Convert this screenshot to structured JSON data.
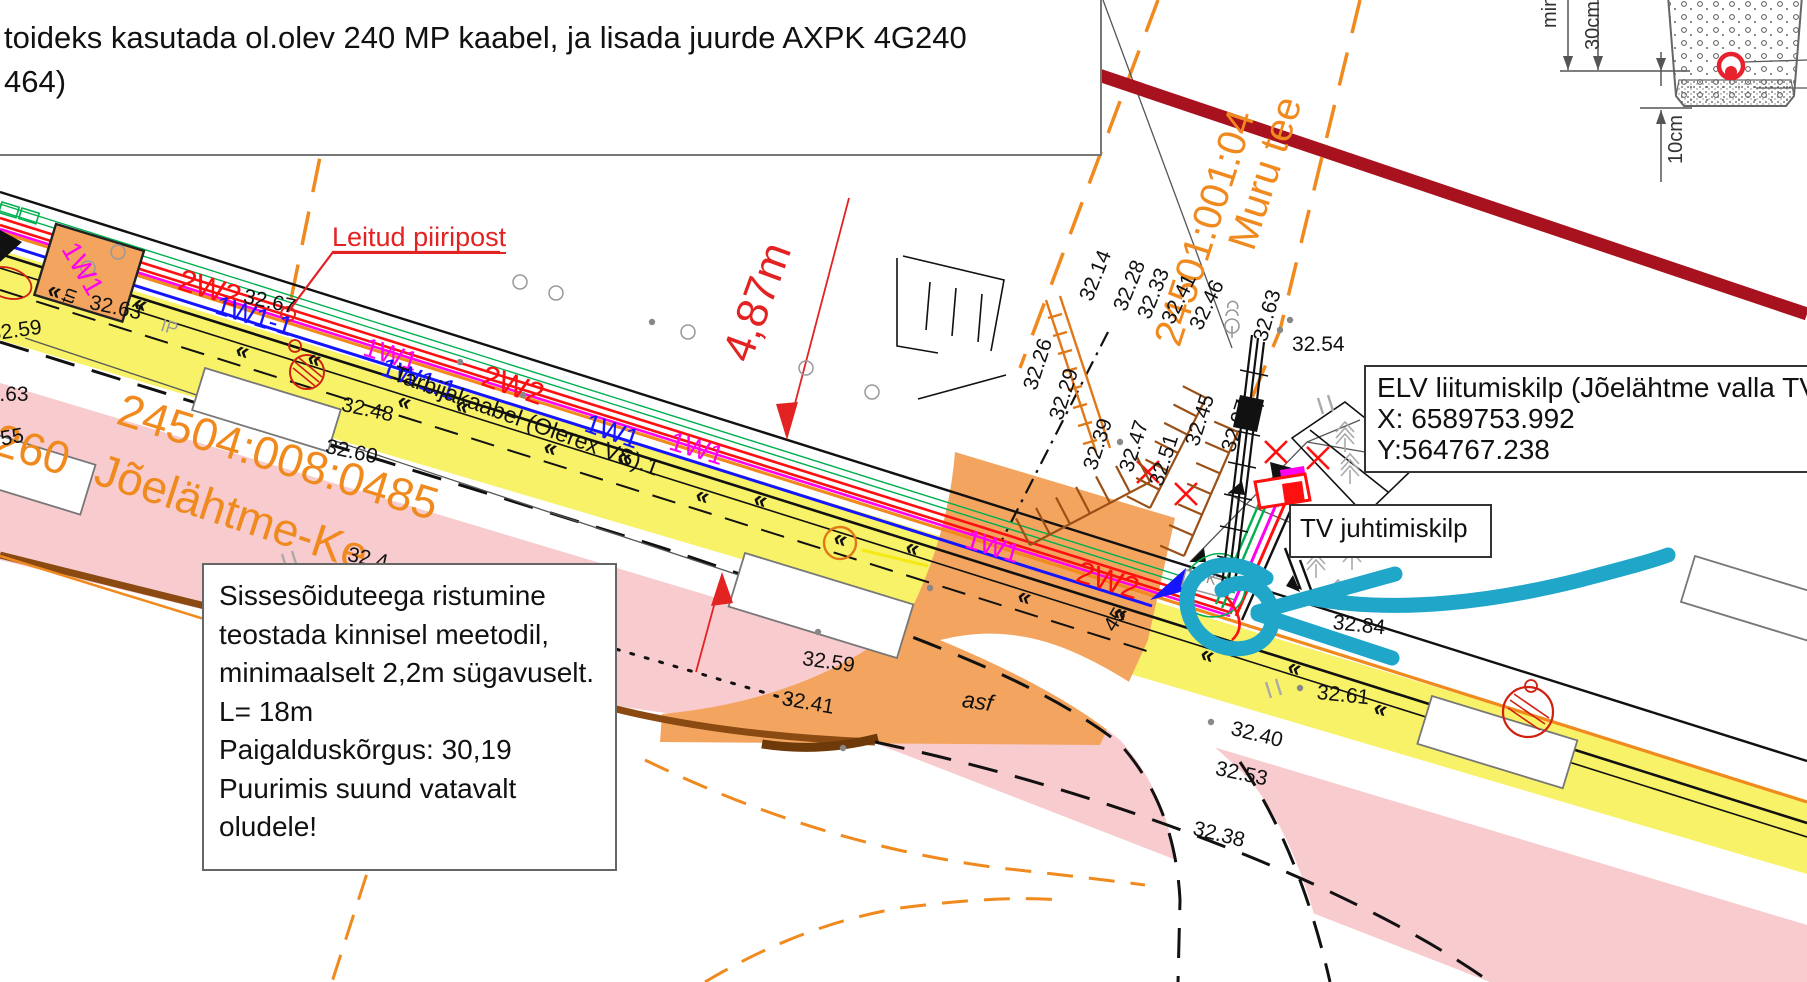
{
  "colors": {
    "road_pink": "#f8cbce",
    "verge_yellow": "#f8f268",
    "driveway_tan": "#f3a55f",
    "boundary_orange": "#f08a1e",
    "existing_cable_red": "#ff1010",
    "project_cable_blue": "#1515ff",
    "project_cable_magenta": "#ff00f0",
    "comm_green": "#00b050",
    "road_edge_brown": "#8a4a12",
    "import_line_darkred": "#a8121e",
    "annotation_cyan": "#1fa6c9"
  },
  "note_box": {
    "line1": "toideks kasutada ol.olev 240 MP kaabel, ja lisada juurde AXPK 4G240",
    "line2": "464)"
  },
  "crossing_note": {
    "lines": [
      "Sissesõiduteega ristumine",
      "teostada kinnisel meetodil,",
      "minimaalselt 2,2m sügavuselt.",
      "L= 18m",
      "Paigalduskõrgus: 30,19",
      "Puurimis suund vatavalt",
      "oludele!"
    ]
  },
  "elv_box": {
    "line1": "ELV liitumiskilp (Jõelähtme valla TV ta",
    "line2": "X: 6589753.992",
    "line3": "Y:564767.238"
  },
  "tv_box": {
    "label": "TV juhtimiskilp"
  },
  "callouts": {
    "leitud_piiripost": {
      "t": "Leitud piiripost",
      "x": 332,
      "y": 224,
      "s": 27
    },
    "dimension_487": {
      "t": "4,87m",
      "x": 716,
      "y": 352,
      "r": -70,
      "s": 44
    }
  },
  "parcel_labels": [
    {
      "t": "24504:008:0485",
      "x": 126,
      "y": 386,
      "r": 17,
      "s": 46
    },
    {
      "t": "Jõelähtme-Ke",
      "x": 104,
      "y": 446,
      "r": 18,
      "s": 46
    },
    {
      "t": "260",
      "x": 2,
      "y": 416,
      "r": 17,
      "s": 46
    },
    {
      "t": "24501:001:04",
      "x": 1148,
      "y": 338,
      "r": -72,
      "s": 40
    },
    {
      "t": "Muru tee",
      "x": 1222,
      "y": 242,
      "r": -72,
      "s": 40
    }
  ],
  "cable_labels": [
    {
      "t": "1W1",
      "x": 80,
      "y": 238,
      "r": 60,
      "s": 27,
      "c": "#ff00f0"
    },
    {
      "t": "2W2",
      "x": 184,
      "y": 264,
      "r": 17,
      "s": 31,
      "c": "#ff1010"
    },
    {
      "t": "1W1-1",
      "x": 220,
      "y": 292,
      "r": 17,
      "s": 27,
      "c": "#1515ff"
    },
    {
      "t": "1W1",
      "x": 368,
      "y": 334,
      "r": 17,
      "s": 27,
      "c": "#ff00f0"
    },
    {
      "t": "1W1.1",
      "x": 386,
      "y": 354,
      "r": 19,
      "s": 27,
      "c": "#1515ff"
    },
    {
      "t": "2W2",
      "x": 488,
      "y": 360,
      "r": 19,
      "s": 31,
      "c": "#ff1010"
    },
    {
      "t": "Tarbijakaabel (Olerex VS).1",
      "x": 398,
      "y": 362,
      "r": 20,
      "s": 23,
      "c": "#111111"
    },
    {
      "t": "1W1",
      "x": 590,
      "y": 410,
      "r": 19,
      "s": 27,
      "c": "#1515ff"
    },
    {
      "t": "1W1",
      "x": 674,
      "y": 428,
      "r": 17,
      "s": 27,
      "c": "#ff00f0"
    },
    {
      "t": "1W1",
      "x": 970,
      "y": 526,
      "r": 17,
      "s": 27,
      "c": "#ff00f0"
    },
    {
      "t": "2W2",
      "x": 1082,
      "y": 556,
      "r": 17,
      "s": 31,
      "c": "#ff1010"
    }
  ],
  "elevation_labels": [
    {
      "t": "32.63",
      "x": 92,
      "y": 292,
      "r": 12
    },
    {
      "t": "32.67",
      "x": 246,
      "y": 286,
      "r": 12
    },
    {
      "t": "32.59",
      "x": -12,
      "y": 324,
      "r": -8
    },
    {
      "t": "32.63",
      "x": -24,
      "y": 384,
      "r": 0
    },
    {
      "t": "32.55",
      "x": -30,
      "y": 434,
      "r": -10
    },
    {
      "t": "32.48",
      "x": 344,
      "y": 394,
      "r": 12
    },
    {
      "t": "32.60",
      "x": 328,
      "y": 436,
      "r": 12
    },
    {
      "t": "32.4",
      "x": 350,
      "y": 544,
      "r": 12
    },
    {
      "t": "32.59",
      "x": 804,
      "y": 648,
      "r": 8
    },
    {
      "t": "32.41",
      "x": 784,
      "y": 688,
      "r": 10
    },
    {
      "t": "asf",
      "x": 964,
      "y": 688,
      "r": 8,
      "s": 23,
      "i": 1
    },
    {
      "t": "32.40",
      "x": 1234,
      "y": 718,
      "r": 14
    },
    {
      "t": "32.53",
      "x": 1218,
      "y": 758,
      "r": 12
    },
    {
      "t": "32.38",
      "x": 1196,
      "y": 818,
      "r": 14
    },
    {
      "t": "32.61",
      "x": 1318,
      "y": 682,
      "r": 6
    },
    {
      "t": "32.84",
      "x": 1334,
      "y": 612,
      "r": 6
    },
    {
      "t": "32.54",
      "x": 1292,
      "y": 334,
      "r": 0
    },
    {
      "t": "32.78",
      "x": 1368,
      "y": 446,
      "r": 0
    },
    {
      "t": "32.14",
      "x": 1076,
      "y": 296,
      "r": -68
    },
    {
      "t": "32.28",
      "x": 1110,
      "y": 306,
      "r": -68
    },
    {
      "t": "32.33",
      "x": 1134,
      "y": 314,
      "r": -68
    },
    {
      "t": "32.41",
      "x": 1158,
      "y": 318,
      "r": -64
    },
    {
      "t": "32.46",
      "x": 1186,
      "y": 324,
      "r": -64
    },
    {
      "t": "32.26",
      "x": 1020,
      "y": 386,
      "r": -72
    },
    {
      "t": "32.29",
      "x": 1046,
      "y": 416,
      "r": -72
    },
    {
      "t": "32.39",
      "x": 1080,
      "y": 466,
      "r": -72
    },
    {
      "t": "32.47",
      "x": 1116,
      "y": 468,
      "r": -72
    },
    {
      "t": "32.51",
      "x": 1146,
      "y": 482,
      "r": -72
    },
    {
      "t": "32.45",
      "x": 1182,
      "y": 442,
      "r": -72
    },
    {
      "t": "32.97",
      "x": 1218,
      "y": 448,
      "r": -72
    },
    {
      "t": "45",
      "x": 1100,
      "y": 624,
      "r": -58
    },
    {
      "t": "32.63",
      "x": 1250,
      "y": 338,
      "r": -74
    },
    {
      "t": "tn",
      "x": 58,
      "y": 300,
      "r": -70,
      "s": 19
    },
    {
      "t": "IP",
      "x": 164,
      "y": 316,
      "r": 17,
      "s": 18,
      "c": "#9a9a9a"
    },
    {
      "t": "LUK",
      "x": 1190,
      "y": 566,
      "r": 15,
      "s": 15,
      "c": "#8a8a8a"
    }
  ],
  "detail_section": {
    "labels": [
      {
        "t": "min",
        "x": 1540,
        "y": 28,
        "r": -90,
        "s": 20,
        "c": "#333333"
      },
      {
        "t": "30cm",
        "x": 1583,
        "y": 50,
        "r": -90,
        "s": 20,
        "c": "#333333"
      },
      {
        "t": "10cm",
        "x": 1666,
        "y": 164,
        "r": -90,
        "s": 20,
        "c": "#333333"
      }
    ]
  }
}
